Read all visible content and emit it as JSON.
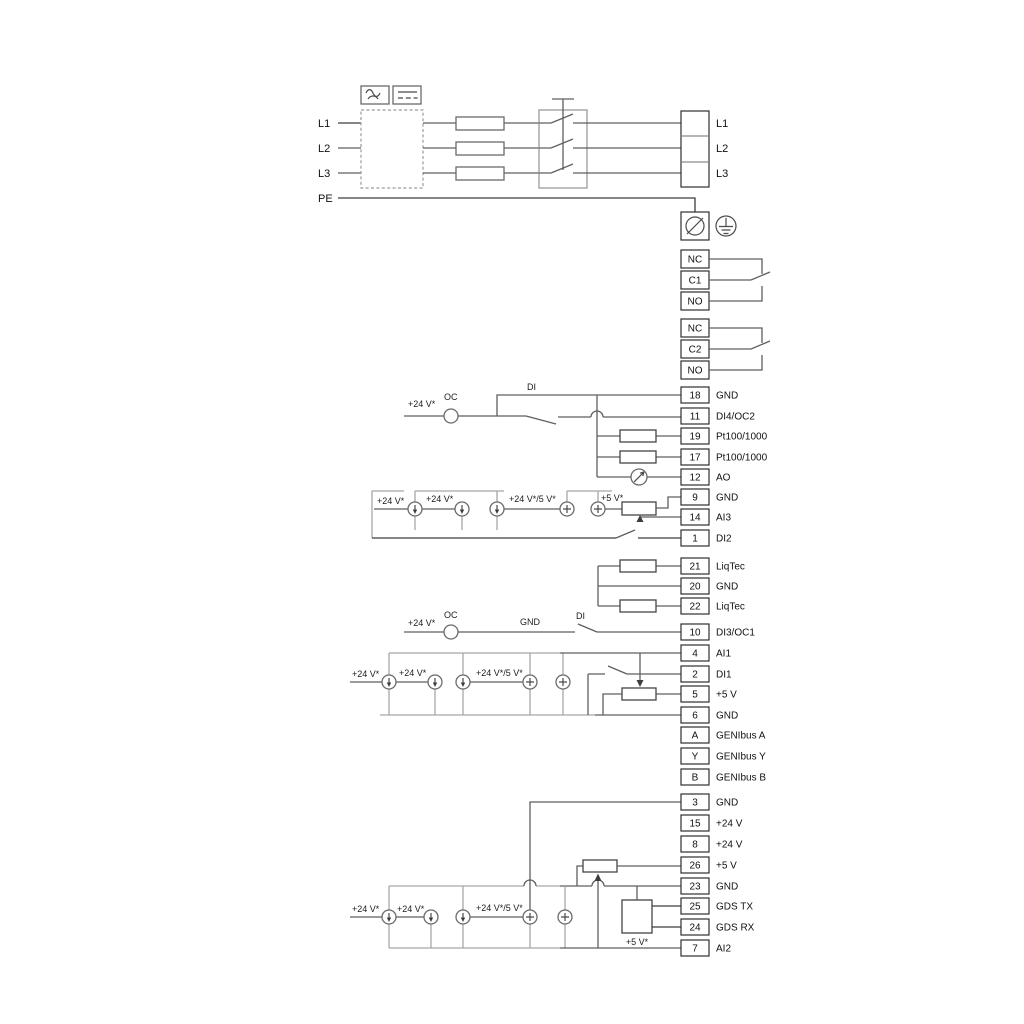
{
  "power": {
    "inputs": [
      "L1",
      "L2",
      "L3",
      "PE"
    ],
    "outputs": [
      "L1",
      "L2",
      "L3"
    ]
  },
  "relays": {
    "r1": [
      "NC",
      "C1",
      "NO"
    ],
    "r2": [
      "NC",
      "C2",
      "NO"
    ]
  },
  "terminals": [
    {
      "num": "18",
      "label": "GND"
    },
    {
      "num": "11",
      "label": "DI4/OC2"
    },
    {
      "num": "19",
      "label": "Pt100/1000"
    },
    {
      "num": "17",
      "label": "Pt100/1000"
    },
    {
      "num": "12",
      "label": "AO"
    },
    {
      "num": "9",
      "label": "GND"
    },
    {
      "num": "14",
      "label": "AI3"
    },
    {
      "num": "1",
      "label": "DI2"
    },
    {
      "num": "21",
      "label": "LiqTec"
    },
    {
      "num": "20",
      "label": "GND"
    },
    {
      "num": "22",
      "label": "LiqTec"
    },
    {
      "num": "10",
      "label": "DI3/OC1"
    },
    {
      "num": "4",
      "label": "AI1"
    },
    {
      "num": "2",
      "label": "DI1"
    },
    {
      "num": "5",
      "label": "+5 V"
    },
    {
      "num": "6",
      "label": "GND"
    },
    {
      "num": "A",
      "label": "GENIbus A"
    },
    {
      "num": "Y",
      "label": "GENIbus Y"
    },
    {
      "num": "B",
      "label": "GENIbus B"
    },
    {
      "num": "3",
      "label": "GND"
    },
    {
      "num": "15",
      "label": "+24 V"
    },
    {
      "num": "8",
      "label": "+24 V"
    },
    {
      "num": "26",
      "label": "+5 V"
    },
    {
      "num": "23",
      "label": "GND"
    },
    {
      "num": "25",
      "label": "GDS TX"
    },
    {
      "num": "24",
      "label": "GDS RX"
    },
    {
      "num": "7",
      "label": "AI2"
    }
  ],
  "annotations": {
    "v24": "+24 V*",
    "v24v5": "+24 V*/5 V*",
    "v5": "+5 V*",
    "oc": "OC",
    "di": "DI",
    "gnd": "GND"
  }
}
